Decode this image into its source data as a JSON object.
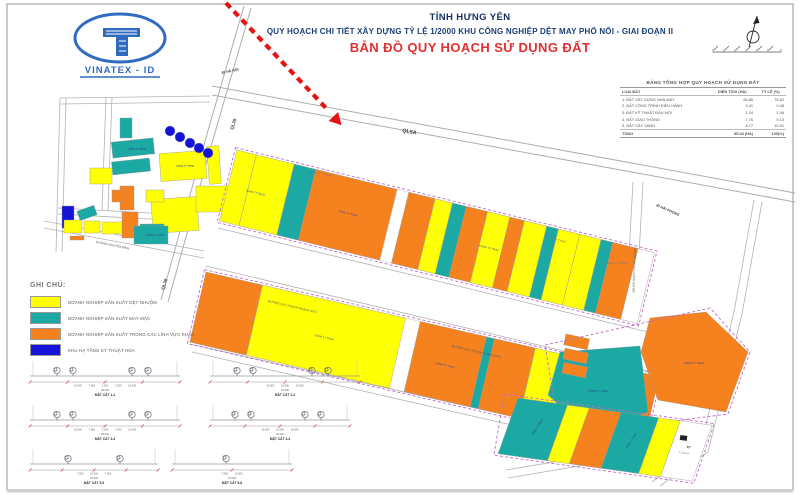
{
  "header": {
    "province": "TỈNH HƯNG YÊN",
    "subtitle": "QUY HOẠCH CHI TIẾT XÂY DỰNG TỶ LỆ 1/2000 KHU CÔNG NGHIỆP DỆT MAY PHỐ NỐI - GIAI ĐOẠN II",
    "map_title": "BẢN ĐỒ QUY HOẠCH SỬ DỤNG ĐẤT"
  },
  "logo": {
    "text": "VINATEX - ID"
  },
  "legend": {
    "title": "GHI CHÚ:",
    "items": [
      {
        "label": "DOANH NGHIỆP SẢN XUẤT DỆT NHUỘM",
        "color": "#FFFF05"
      },
      {
        "label": "DOANH NGHIỆP SẢN XUẤT MAY MẶC",
        "color": "#1CA9A3"
      },
      {
        "label": "DOANH NGHIỆP SẢN XUẤT TRONG CÁC LĨNH VỰC KHÁC",
        "color": "#F5821F"
      },
      {
        "label": "KHU HẠ TẦNG KỸ THUẬT HOA",
        "color": "#1414D9"
      }
    ]
  },
  "land_use_table": {
    "title": "BẢNG TỔNG HỢP QUY HOẠCH SỬ DỤNG ĐẤT",
    "columns": [
      "LOẠI ĐẤT",
      "DIỆN TÍCH (HA)",
      "TỶ LỆ (%)"
    ],
    "rows": [
      [
        "1. ĐẤT XÂY DỰNG NHÀ MÁY",
        "66.86",
        "78.62"
      ],
      [
        "2. ĐẤT CÔNG TRÌNH ĐIỀU HÀNH",
        "0.41",
        "0.48"
      ],
      [
        "3. ĐẤT KỸ THUẬT ĐẦU MỐI",
        "1.24",
        "1.46"
      ],
      [
        "4. ĐẤT GIAO THÔNG",
        "7.76",
        "9.13"
      ],
      [
        "5. ĐẤT CÂY XANH",
        "8.77",
        "10.31"
      ]
    ],
    "total": [
      "TỔNG",
      "85.04 (HA)",
      "100(%)"
    ]
  },
  "roads": {
    "ql5a": "QL5A",
    "ql39": "QL39",
    "to_hanoi": "ĐI HÀ NỘI",
    "to_haiphong": "ĐI HẢI PHÒNG",
    "cross_road_2": "ĐƯỜNG QUY HOẠCH NGANG SỐ 2",
    "nguyen_binh": "ĐƯỜNG NGUYỄN BÌNH",
    "ip_access": "ĐƯỜNG VÀO KHU CÔNG NGHIỆP"
  },
  "parcels": {
    "generic_label": "CÔNG TY TNHH",
    "kt_code": "KT",
    "kt_area": "1.218 HA"
  },
  "sections": {
    "items": [
      {
        "label": "MẶT CẮT 1-1",
        "dims": "15.000 7.500 3.000 7.500 15.000",
        "total": "48.000"
      },
      {
        "label": "MẶT CẮT 2-2",
        "dims": "15.000 10.500 15.000",
        "total": "40.500"
      },
      {
        "label": "MẶT CẮT 3-3",
        "dims": "15.000 7.500 3.000 7.500 15.000",
        "total": "48.000"
      },
      {
        "label": "MẶT CẮT 4-4",
        "dims": "15.000 10.500 15.000",
        "total": "40.500"
      },
      {
        "label": "MẶT CẮT 5-5",
        "dims": "7.500 10.500 7.500",
        "total": "25.500"
      },
      {
        "label": "MẶT CẮT 6-6",
        "dims": "7.500 15.000",
        "total": "22.500"
      }
    ]
  }
}
